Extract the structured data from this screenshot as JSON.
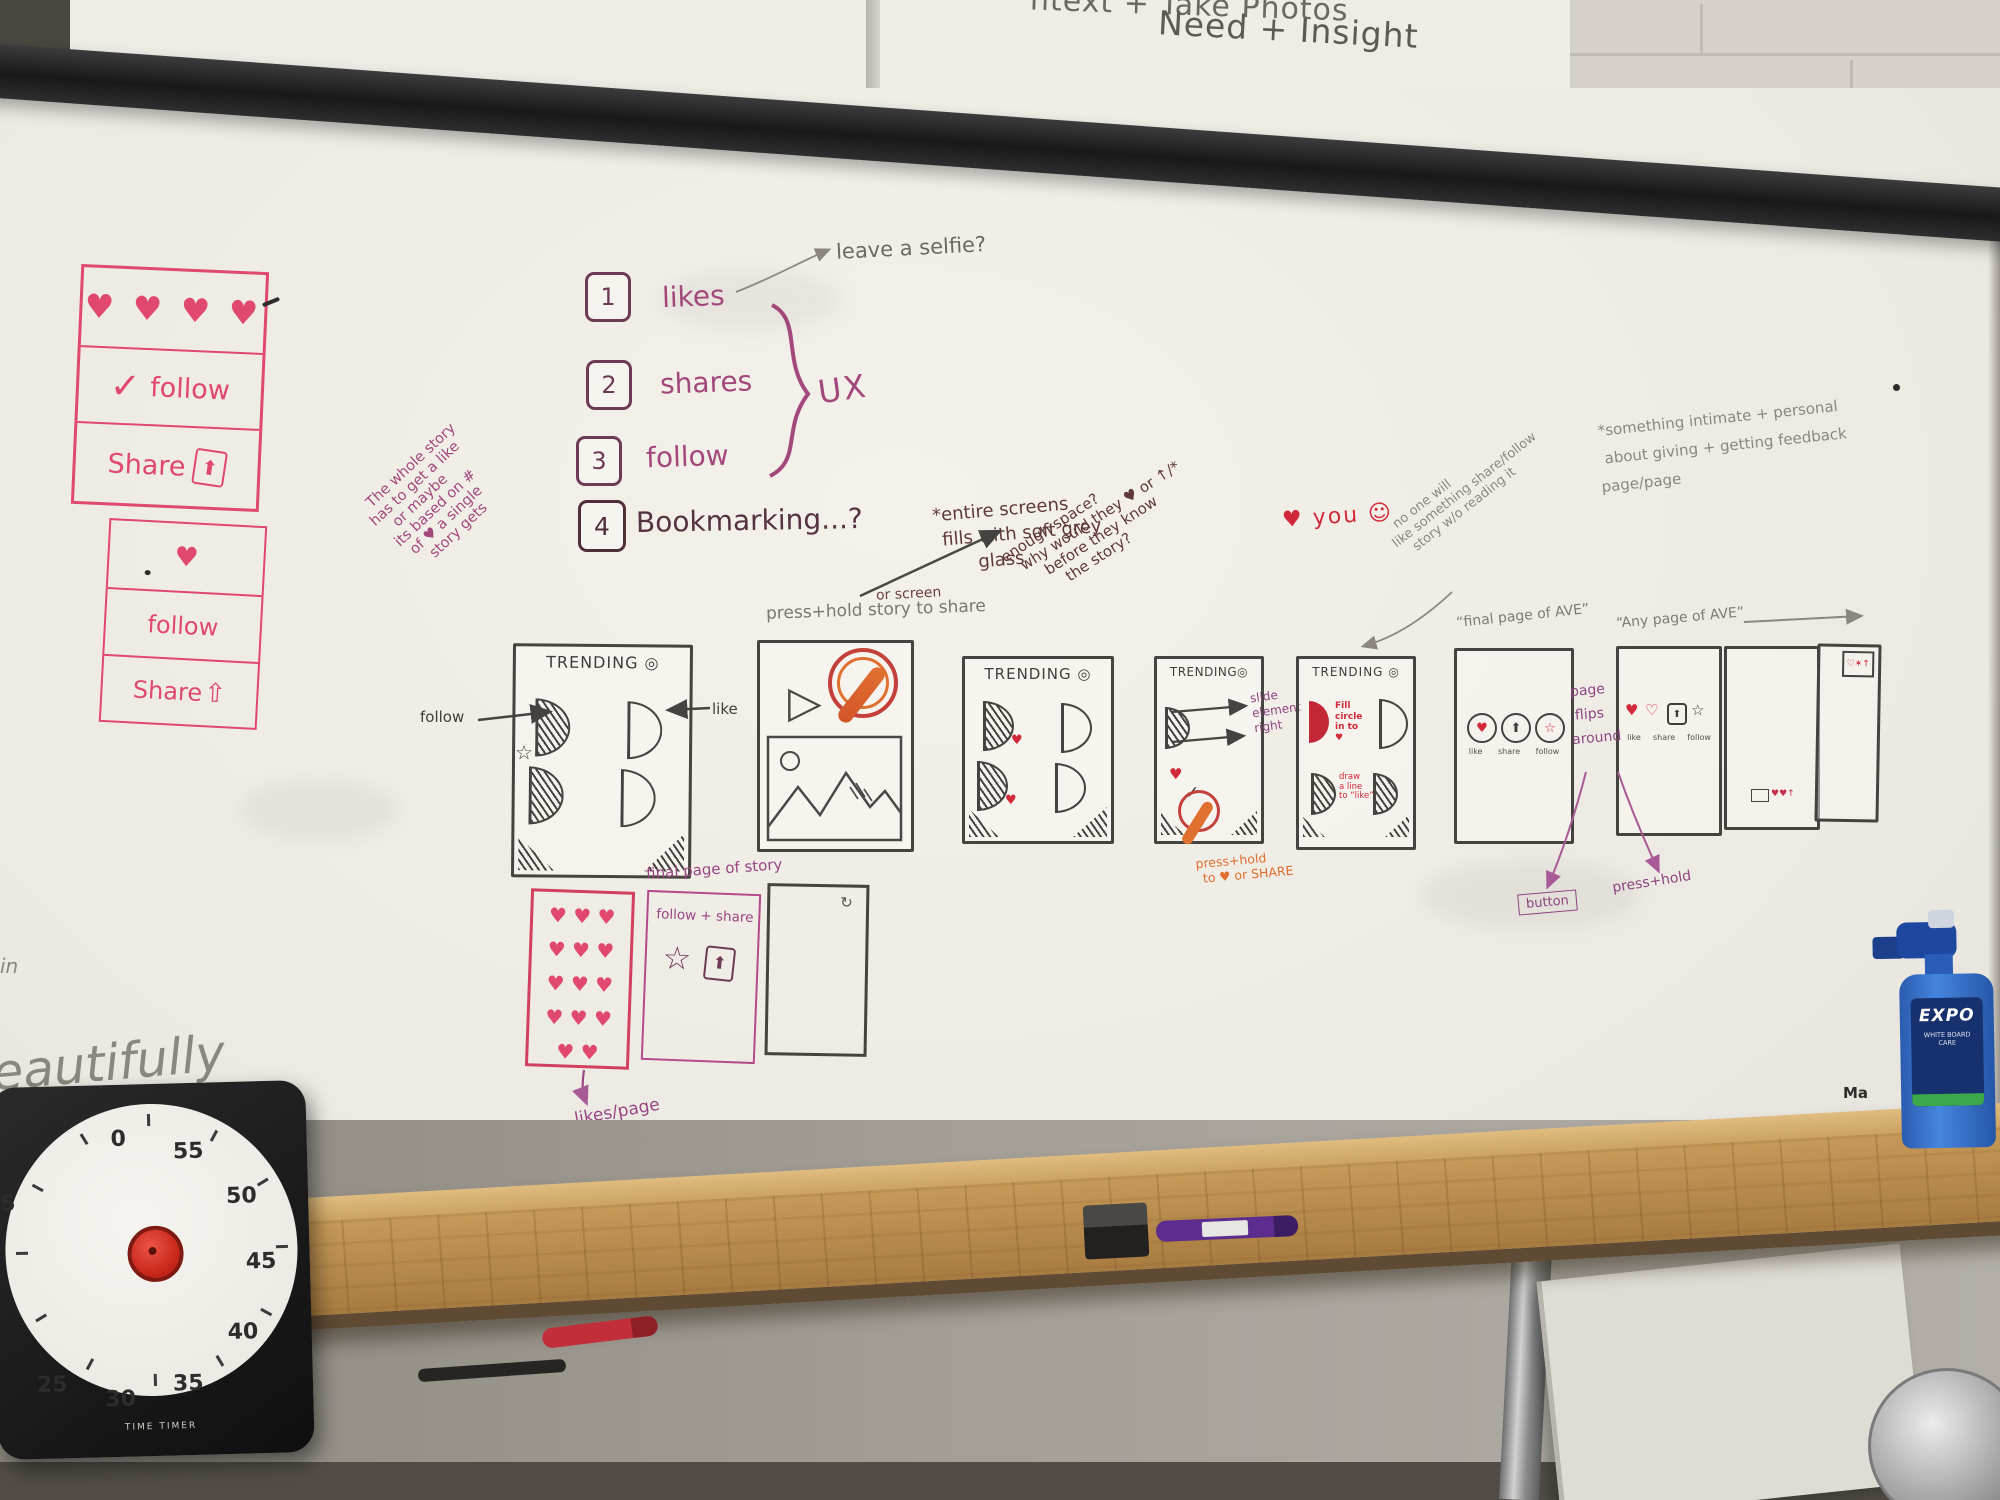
{
  "board_top": {
    "fragment": "ntext + Take Photos",
    "title": "Need + Insight"
  },
  "icons": {
    "target": "◎",
    "heart": "♥",
    "heart_outline": "♡",
    "share_arrow": "⬆",
    "share_arrow_alt": "⇧",
    "star": "☆",
    "check": "✓",
    "play": "▷",
    "refresh": "↻"
  },
  "pink_panel_top": {
    "hearts": "♥ ♥ ♥ ♥",
    "check": "✓",
    "follow": "follow",
    "share": "Share",
    "share_icon": "⬆"
  },
  "pink_panel_bottom": {
    "heart": "♥",
    "follow": "follow",
    "share": "Share",
    "share_icon": "⇧"
  },
  "ux_list": {
    "items": [
      {
        "num": "1",
        "label": "likes"
      },
      {
        "num": "2",
        "label": "shares"
      },
      {
        "num": "3",
        "label": "follow"
      },
      {
        "num": "4",
        "label": "Bookmarking...?"
      }
    ],
    "brace_label": "UX"
  },
  "notes": {
    "leave_selfie": "leave a selfie?",
    "whole_story": [
      "The whole story",
      "has to get a like",
      "or maybe",
      "its based on #",
      "of ♥ a single",
      "story gets"
    ],
    "press_hold_story": "press+hold story to share",
    "or_screen": "or screen",
    "entire_screens": [
      "*entire screens",
      "fills with soft grey",
      "glass"
    ],
    "enough_space": [
      "enough space?",
      "why would they ♥ or ↑/*",
      "before they know",
      "the story?"
    ],
    "heart_you": "♥ you ☺",
    "no_one": [
      "no one will",
      "like something share/follow",
      "story w/o reading it"
    ],
    "intimate": [
      "*something intimate + personal",
      "about giving + getting feedback",
      "page/page"
    ],
    "final_page_ave": "“final page of AVE”",
    "any_page_ave": "“Any page of AVE”",
    "slide_element": [
      "slide",
      "element",
      "right"
    ],
    "fill_circle": [
      "Fill",
      "circle",
      "in to",
      "♥"
    ],
    "draw_line": [
      "draw",
      "a line",
      "to “like”"
    ],
    "press_hold_share": [
      "press+hold",
      "to ♥ or SHARE"
    ],
    "follow_label": "follow",
    "like_label": "like",
    "page_flips": [
      "page",
      "flips",
      "around"
    ],
    "button": "button",
    "press_hold2": "press+hold",
    "final_page_story": "final page of story",
    "follow_plus_share": "follow + share",
    "likes_page": "likes/page",
    "beautifully": "eautifully",
    "in_fragment": "in",
    "board_brand": "Ma"
  },
  "wireframes": {
    "trending": "TRENDING",
    "circle_labels": [
      "like",
      "share",
      "follow"
    ],
    "mini_glyphs": "♥♥↑",
    "corner_glyphs": "♡✶↑",
    "heart_rows": [
      "♥ ♥ ♥",
      "♥ ♥ ♥",
      "♥ ♥ ♥",
      "♥ ♥ ♥",
      "♥ ♥"
    ]
  },
  "timer": {
    "numbers": [
      "0",
      "55",
      "50",
      "45",
      "40",
      "35",
      "30",
      "25",
      "5"
    ],
    "brand": "TIME TIMER"
  },
  "bottle": {
    "brand": "EXPO",
    "line1": "WHITE BOARD",
    "line2": "CARE"
  }
}
